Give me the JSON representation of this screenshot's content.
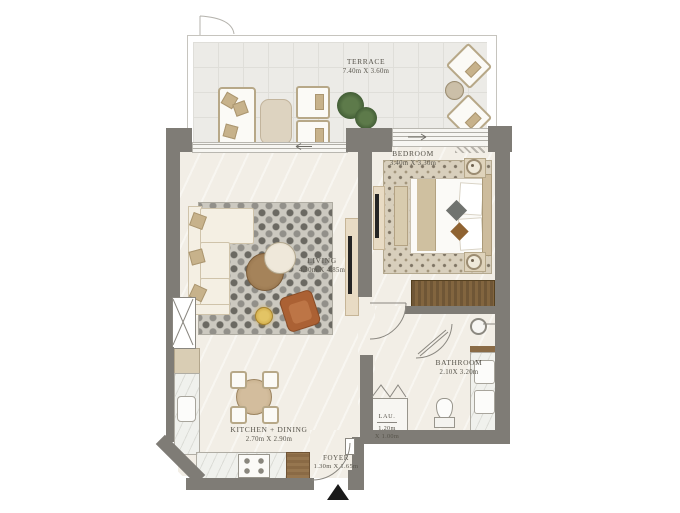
{
  "plan": {
    "rooms": {
      "terrace": {
        "name": "TERRACE",
        "dims": "7.40m X 3.60m"
      },
      "bedroom": {
        "name": "BEDROOM",
        "dims": "3.40m X 3.30m"
      },
      "living": {
        "name": "LIVING",
        "dims": "4.30m X 4.85m"
      },
      "kitchen_dining": {
        "name": "KITCHEN + DINING",
        "dims": "2.70m X 2.90m"
      },
      "bathroom": {
        "name": "BATHROOM",
        "dims": "2.10X 3.20m"
      },
      "laundry": {
        "name": "LAU.",
        "dim_w": "1.20m",
        "dim_h": "X 1.00m"
      },
      "foyer": {
        "name": "FOYER",
        "dims": "1.30m X 1.65m"
      }
    },
    "colors": {
      "wall": "#7f7c76",
      "floor": "#f2eee6",
      "terrace_floor": "#ecebe7",
      "wood_dark": "#6f5636",
      "wood_mid": "#9c7a52",
      "cream_furniture": "#f3eee2",
      "rust_armchair": "#ab6134",
      "label_text": "#57544b"
    }
  }
}
